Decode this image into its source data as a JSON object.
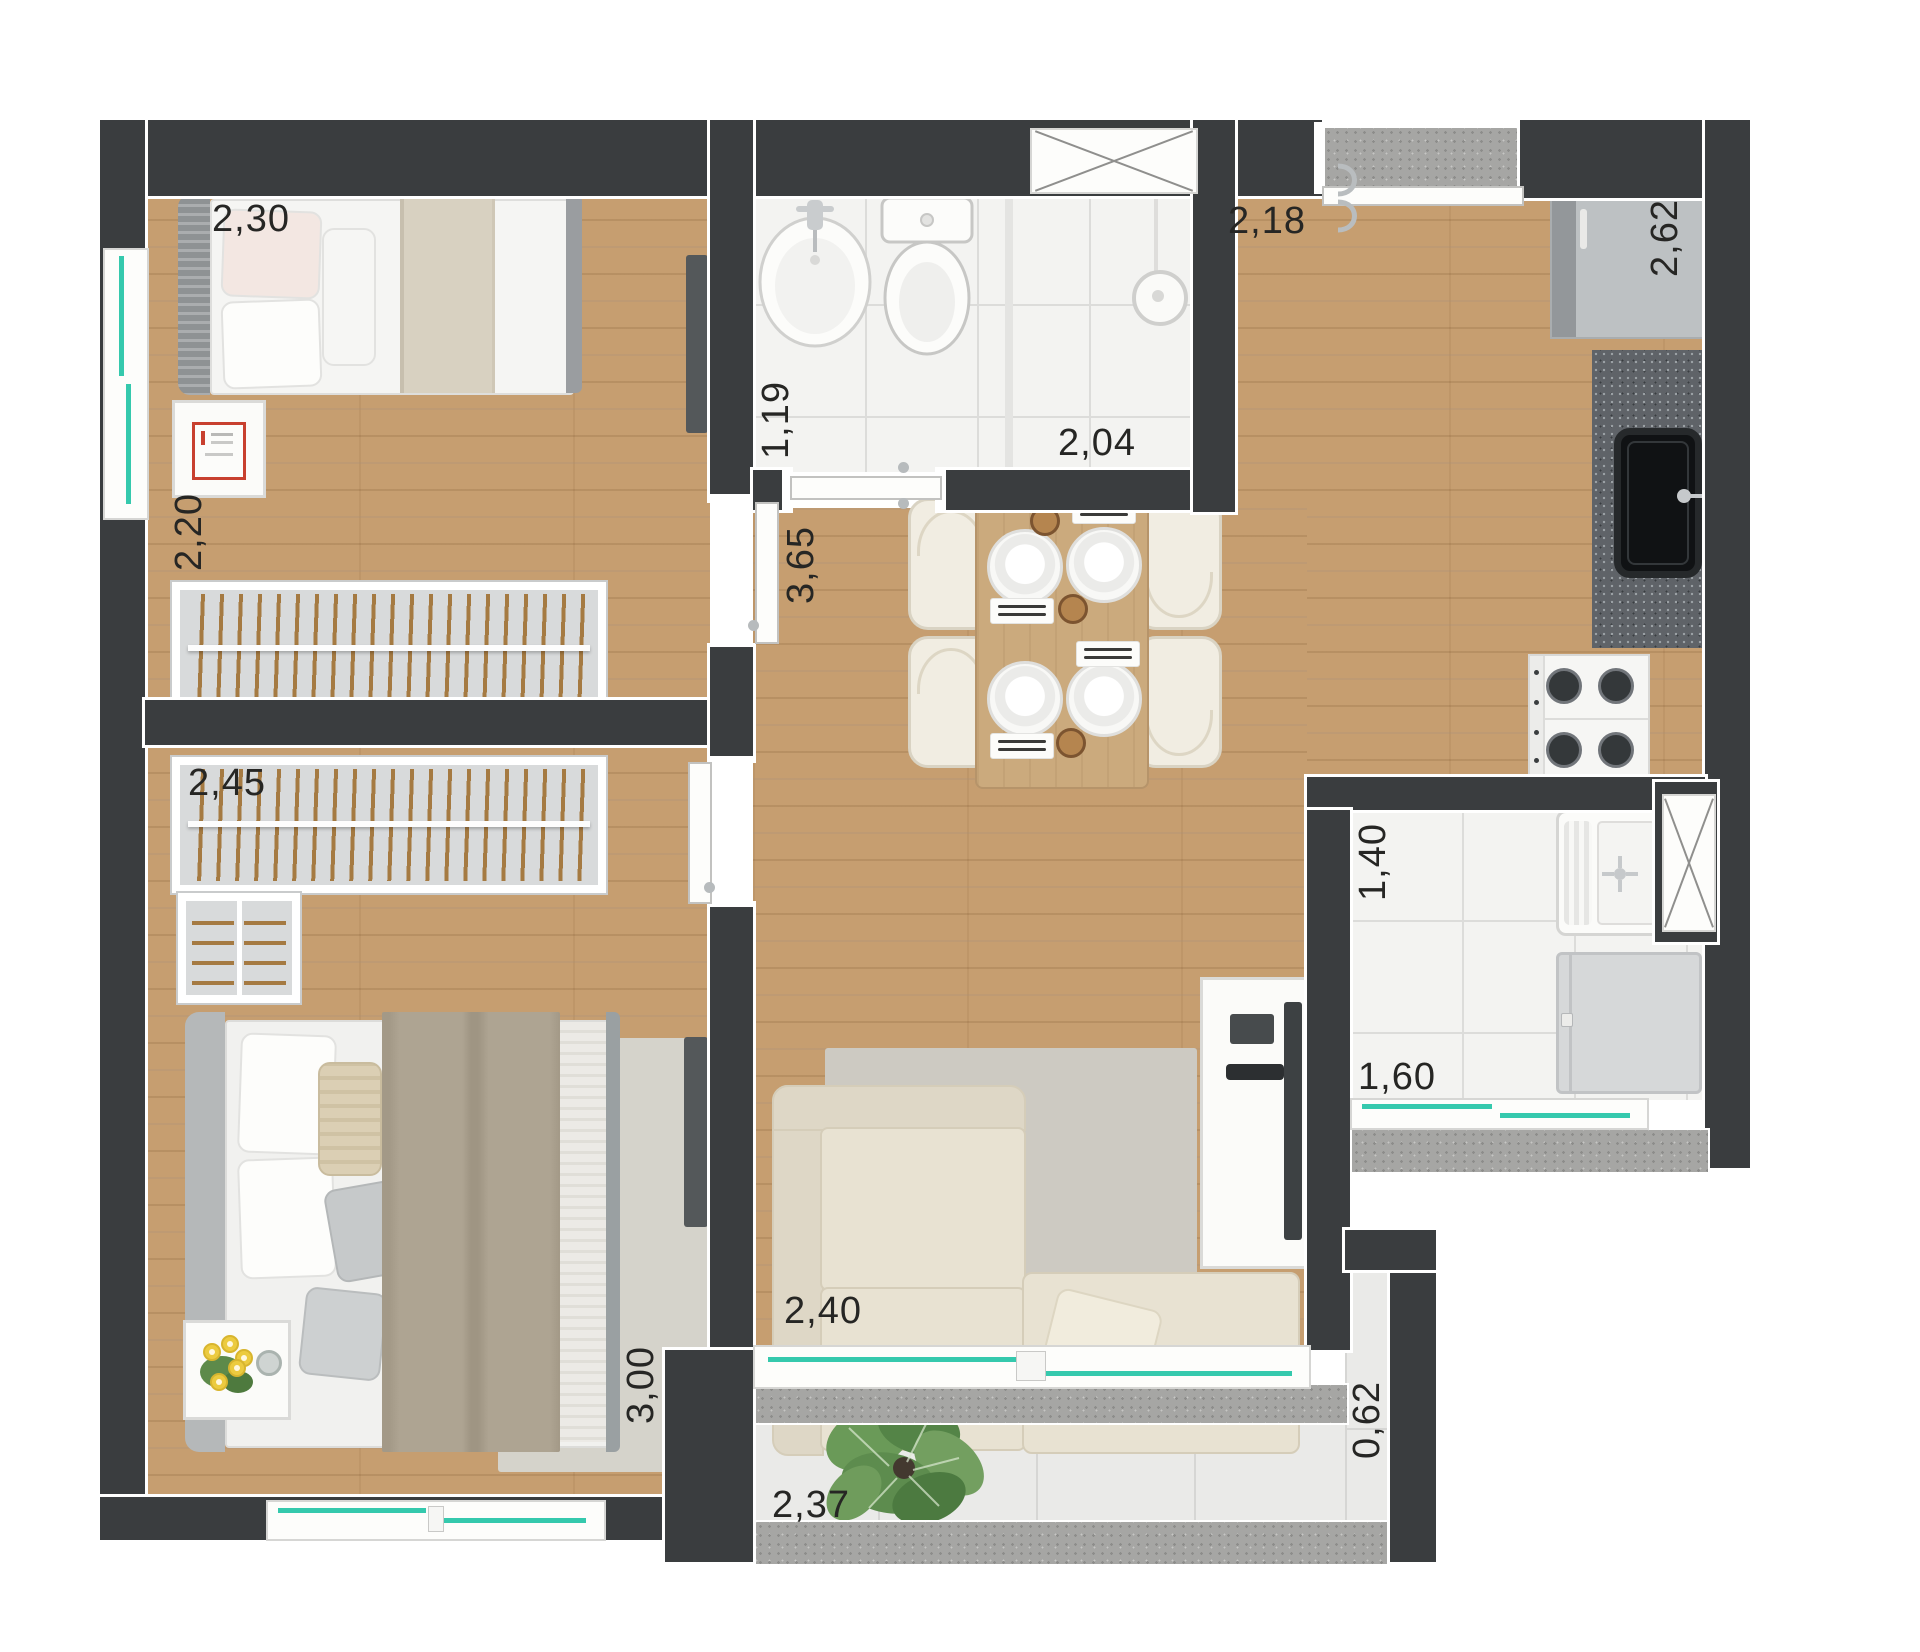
{
  "dimensions": {
    "bedroom1_width": "2,30",
    "bedroom1_depth": "2,20",
    "closet_wall_width": "2,45",
    "bedroom2_depth": "3,00",
    "bathroom_entry": "1,19",
    "hall_length": "3,65",
    "bathroom_width": "2,04",
    "kitchen_entry_width": "2,18",
    "kitchen_depth": "2,62",
    "service_width": "1,40",
    "service_depth": "1,60",
    "living_width": "2,40",
    "balcony_width": "2,37",
    "balcony_depth": "0,62"
  },
  "colors": {
    "wall": "#3a3d3f",
    "wood_floor": "#c69e70",
    "tile_floor": "#f3f3f1",
    "window_glass": "#35c9ad",
    "counter_granite": "#5f6368",
    "sofa_beige": "#e8e2d2"
  }
}
